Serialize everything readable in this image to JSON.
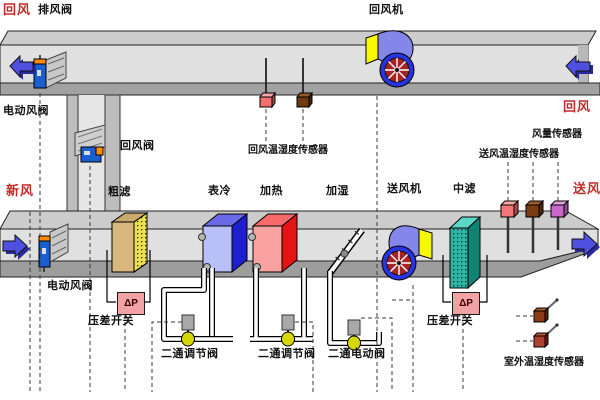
{
  "diagram": {
    "subject": "air-handling-unit-monitoring-diagram"
  },
  "labels": {
    "return_air_top_left": {
      "text": "回风",
      "color": "#c32a2a"
    },
    "exhaust_damper": {
      "text": "排风阀"
    },
    "return_fan": {
      "text": "回风机"
    },
    "return_air_right": {
      "text": "回风",
      "color": "#c32a2a"
    },
    "motor_damper_top": {
      "text": "电动风阀"
    },
    "return_damper": {
      "text": "回风阀"
    },
    "fresh_air": {
      "text": "新风",
      "color": "#c32a2a"
    },
    "coarse_filter": {
      "text": "粗滤"
    },
    "cooling_coil": {
      "text": "表冷"
    },
    "heating_coil": {
      "text": "加热"
    },
    "humidifier": {
      "text": "加湿"
    },
    "supply_fan": {
      "text": "送风机"
    },
    "mid_filter": {
      "text": "中滤"
    },
    "supply_air": {
      "text": "送风",
      "color": "#c32a2a"
    },
    "return_air_th_sensor": {
      "text": "回风温湿度传感器"
    },
    "airflow_sensor": {
      "text": "风量传感器"
    },
    "supply_air_th_sensor": {
      "text": "送风温湿度传感器"
    },
    "motor_damper_bottom": {
      "text": "电动风阀"
    },
    "dp_switch_left": {
      "text": "压差开关"
    },
    "dp_switch_right": {
      "text": "压差开关"
    },
    "valve_regulating_1": {
      "text": "二通调节阀"
    },
    "valve_regulating_2": {
      "text": "二通调节阀"
    },
    "valve_motorized": {
      "text": "二通电动阀"
    },
    "outdoor_th_sensor": {
      "text": "室外温湿度传感器"
    },
    "dp_symbol_left": {
      "text": "ΔP"
    },
    "dp_symbol_right": {
      "text": "ΔP"
    }
  },
  "colors": {
    "red_label": "#c32a2a",
    "duct_top_face": "#cccccc",
    "duct_body": "#e0e0e0",
    "duct_bottom_band": "#9d9d9d",
    "arrow_blue": "#5050e0",
    "fan_housing": "#8486ea",
    "fan_ring": "#2834e0",
    "fan_blades": "#a82424",
    "fan_side_panel": "#f8f800",
    "cooler_front": "#b9c0f7",
    "cooler_side": "#1f1fd0",
    "heater_front": "#f8a2a2",
    "heater_side": "#e41414",
    "coarse_filter_front": "#d8b77e",
    "coarse_filter_side": "#ece04e",
    "mid_filter_front": "#2fb3a3",
    "dp_box": "#f2a2a2",
    "damper_actuator": "#1a5fd0",
    "damper_stripe": "#ff8c00",
    "ball_valve": "#d6d600"
  }
}
